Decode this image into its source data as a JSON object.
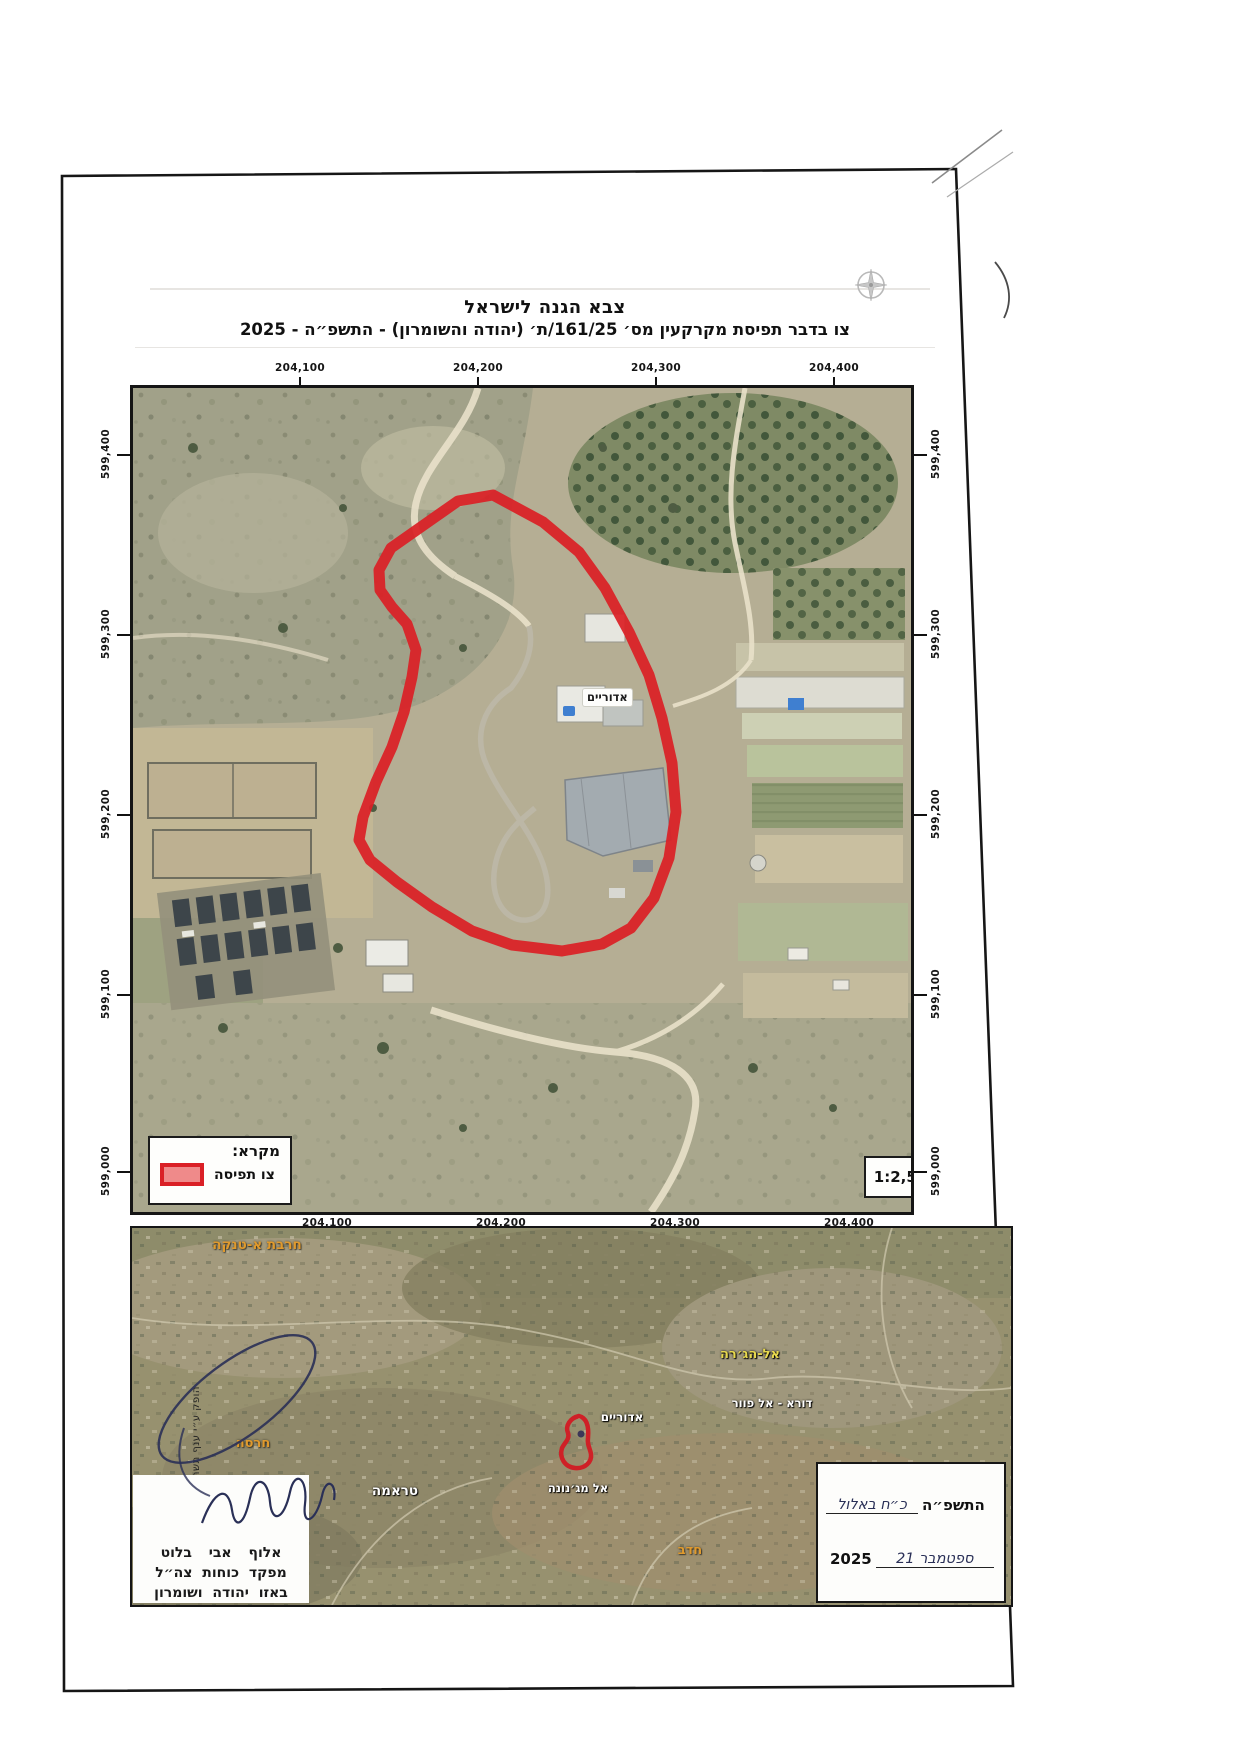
{
  "header": {
    "line1": "צבא הגנה לישראל",
    "line2": "צו בדבר תפיסת מקרקעין מס׳ 161/25/ת׳ (יהודה והשומרון) - התשפ״ה - 2025"
  },
  "main_map": {
    "x_ticks": [
      "204,100",
      "204,200",
      "204,300",
      "204,400"
    ],
    "y_ticks": [
      "599,400",
      "599,300",
      "599,200",
      "599,100",
      "599,000"
    ],
    "site_label": "אדוריים",
    "legend": {
      "title": "מקרא:",
      "item": "צו תפיסה",
      "swatch_color": "#da2026"
    },
    "scale": "קנ״מ: 1:2,500"
  },
  "overview_map": {
    "labels": [
      {
        "text": "חרבת א-טנקה",
        "color": "orange"
      },
      {
        "text": "אל-הג׳רה",
        "color": "yellow"
      },
      {
        "text": "דורא - אל פוור",
        "color": "white"
      },
      {
        "text": "אדוריים",
        "color": "white"
      },
      {
        "text": "חרסה",
        "color": "orange"
      },
      {
        "text": "טראמה",
        "color": "white"
      },
      {
        "text": "אל מג׳נונה",
        "color": "white"
      },
      {
        "text": "חדב",
        "color": "orange"
      }
    ]
  },
  "signature_block": {
    "line1": "אלוף אבי בלוט",
    "line2": "מפקד כוחות צה״ל",
    "line3": "באזו יהודה ושומרון"
  },
  "date_block": {
    "hebrew_day_handwritten": "כ״ח באלול",
    "hebrew_year_printed": "התשפ״ה",
    "gregorian_day_handwritten": "21 ספטמבר",
    "gregorian_year_printed": "2025"
  },
  "side_note": "הופק ע״י ענף תשתית",
  "colors": {
    "seizure_outline": "#da2026",
    "label_orange": "#e09a2d",
    "label_yellow": "#e8d94e"
  }
}
